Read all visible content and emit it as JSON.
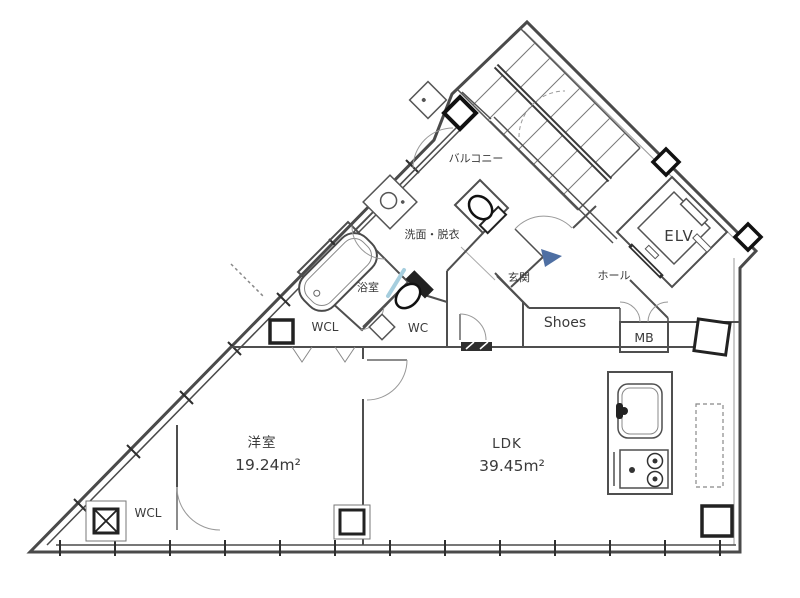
{
  "title": "apartment-floor-plan",
  "colors": {
    "wall": "#4a4a4a",
    "thin": "#8a8a8a",
    "text": "#3a3a3a",
    "arrow": "#4e6fa3",
    "glass": "#a6cede",
    "dark": "#222222"
  },
  "labels": {
    "balcony": "バルコニー",
    "washroom": "洗面・脱衣",
    "bathroom": "浴室",
    "wcl_upper": "WCL",
    "wc": "WC",
    "entrance": "玄関",
    "hall": "ホール",
    "shoes": "Shoes",
    "meter_box": "MB",
    "elevator": "ELV",
    "western_label": "洋室",
    "western_area": "19.24m²",
    "ldk_label": "LDK",
    "ldk_area": "39.45m²",
    "wcl_lower": "WCL"
  },
  "fixtures": {
    "stairs": "staircase",
    "elevator_cab": "elevator-cab",
    "bathtub": "bathtub",
    "wash_basin": "wash-basin",
    "toilet_upper": "toilet",
    "toilet_lower": "toilet",
    "kitchen_sink": "kitchen-sink",
    "kitchen_stove": "gas-stove",
    "refrigerator_space": "refrigerator-space-dashed",
    "entry_arrow": "entry-direction-arrow",
    "columns": "structural-columns",
    "windows": "window-bands"
  }
}
